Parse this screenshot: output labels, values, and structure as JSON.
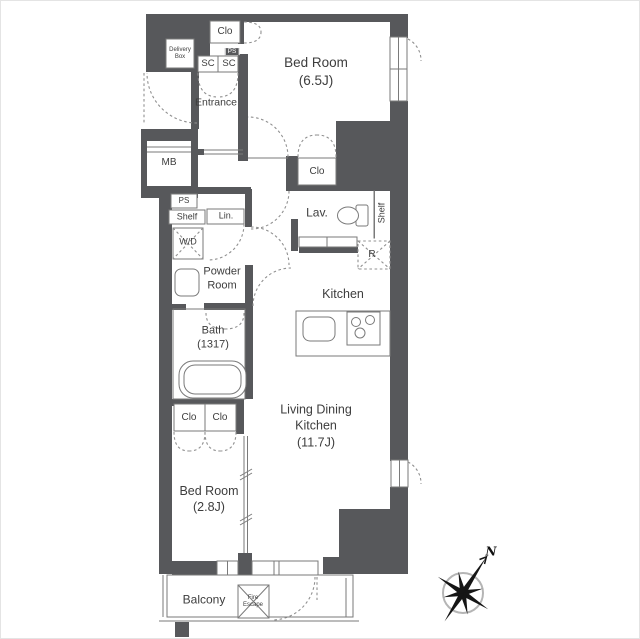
{
  "plan": {
    "delivery_box": {
      "line1": "Delivery",
      "line2": "Box"
    },
    "closets": {
      "top": "Clo",
      "mid": "Clo",
      "bottom_left": "Clo",
      "bottom_right": "Clo"
    },
    "shoe_cupboards": {
      "left": "SC",
      "right": "SC"
    },
    "pipe_space": {
      "badge": "PS",
      "box": "PS"
    },
    "entrance": "Entrance",
    "meter_box": "MB",
    "bedroom1": {
      "name": "Bed Room",
      "size": "(6.5J)"
    },
    "bedroom2": {
      "name": "Bed Room",
      "size": "(2.8J)"
    },
    "shelf_left": "Shelf",
    "shelf_right": "Shelf",
    "linen": "Lin.",
    "washer_dryer": "W/D",
    "powder_room": {
      "line1": "Powder",
      "line2": "Room"
    },
    "bath": {
      "name": "Bath",
      "size": "(1317)"
    },
    "lavatory": "Lav.",
    "refrigerator": "R",
    "kitchen": "Kitchen",
    "ldk": {
      "line1": "Living Dining",
      "line2": "Kitchen",
      "size": "(11.7J)"
    },
    "balcony": "Balcony",
    "fire_escape": {
      "line1": "Fire",
      "line2": "Escape"
    },
    "compass": {
      "north": "N"
    }
  },
  "colors": {
    "wall": "#57585b",
    "line": "#7a7a7a",
    "background": "#ffffff"
  }
}
